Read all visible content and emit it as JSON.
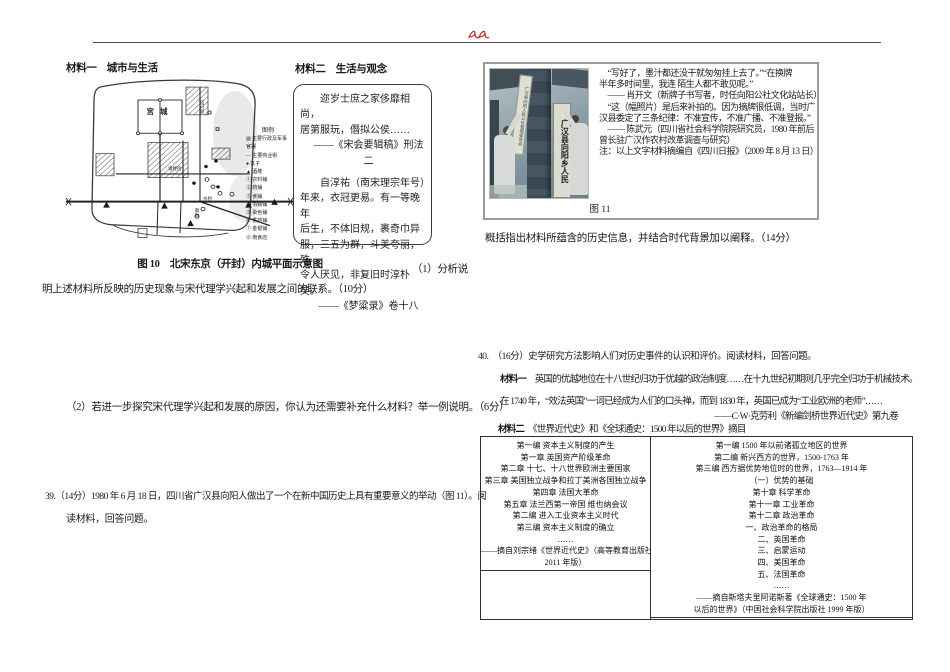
{
  "accent_color": "#cc2020",
  "left": {
    "material1_label": "材料一　城市与生活",
    "material2_label": "材料二　生活与观念",
    "map": {
      "palace_label": "宫城",
      "street_label_1": "马行街",
      "street_label_2": "潘楼街",
      "street_label_3": "州桥",
      "street_label_4": "御街",
      "legend_title": "图例",
      "legend_items": [
        "▨ 主要行政及军事官署",
        "— 主要商业街",
        "● 瓦子",
        "▲ 酒楼",
        "① 衣料铺",
        "② 药铺",
        "③ 食铺",
        "④ 书籍铺",
        "⑤ 染色铺",
        "⑥ 香药铺",
        "⑦ 金银铺",
        "⑧ 南食店"
      ],
      "caption": "图 10　北宋东京（开封）内城平面示意图"
    },
    "material2_quote_lines": [
      {
        "t": "迩岁士庶之家侈靡相尚，",
        "c": "ind"
      },
      {
        "t": "居第服玩，僭拟公侯……"
      },
      {
        "t": "——《宋会要辑稿》刑法二",
        "c": "attr"
      },
      {
        "t": "自淳祐（南宋理宗年号）",
        "c": "ind gap"
      },
      {
        "t": "年来，衣冠更易。有一等晚年"
      },
      {
        "t": "后生，不体旧规，裹奇巾异"
      },
      {
        "t": "服，三五为群，斗美夸丽，殊"
      },
      {
        "t": "令人厌见，非复旧时淳朴矣。"
      },
      {
        "t": "——《梦粱录》卷十八",
        "c": "attr"
      }
    ],
    "q1_lead": "（1）分析说",
    "q1_wrap": "明上述材料所反映的历史现象与宋代理学兴起和发展之间的联系。（10分）",
    "q2": "（2）若进一步探究宋代理学兴起和发展的原因，你认为还需要补充什么材料？举一例说明。（6分）",
    "q39_line1": "39.（14分）1980 年 6 月 18 日，四川省广汉县向阳人做出了一个在新中国历史上具有重要意义的举动（图 11）。阅",
    "q39_line2": "读材料，回答问题。"
  },
  "right": {
    "figure": {
      "caption": "图 11",
      "old_sign_text": "广汉县向阳人民公社管理委员会",
      "new_sign_text": "广汉县向阳乡人民"
    },
    "quote_lines": [
      {
        "t": "　“写好了，墨汁都还没干就匆匆挂上去了。”“在换牌"
      },
      {
        "t": "半年多时间里，我连 陌生人都不敢见呢。”"
      },
      {
        "t": "　—— 肖开文（新牌子书写者，时任向阳公社文化站站长）"
      },
      {
        "t": "　“这（幅照片）是后来补拍的。因为摘牌很低调，当时广"
      },
      {
        "t": "汉县委定了三条纪律：不准宣传，不准广播、不准登报。”"
      },
      {
        "t": "　—— 陈武元（四川省社会科学院院研究员，1980 年前后"
      },
      {
        "t": "曾长驻广汉作农村改革调查与研究）"
      },
      {
        "t": "注：以上文字材料摘编自《四川日报》（2009 年 8 月 13 日）"
      }
    ],
    "q39_task": "概括指出材料所蕴含的历史信息，并结合时代背景加以阐释。（14分）",
    "q40": "40.　（16分）史学研究方法影响人们对历史事件的认识和评价。阅读材料，回答问题。",
    "material1": {
      "label": "材料一",
      "line1": "　英国的优越地位在十八世纪归功于优越的政治制度……在十九世纪初期则几乎完全归功于机械技术。",
      "line2": "在 1740 年，“效法英国”一词已经成为人们的口头禅，而到 1830 年，英国已成为“工业欧洲的老师”……",
      "attribution": "——C·W·克劳利《新编剑桥世界近代史》第九卷"
    },
    "material2": {
      "label": "材料二",
      "title": "　《世界近代史》和《全球通史：1500 年以后的世界》摘目"
    },
    "table": {
      "left_lines": [
        {
          "t": "第一编 资本主义制度的产生"
        },
        {
          "t": "第一章 英国资产阶级革命"
        },
        {
          "t": "第二章 十七、十八世界欧洲主要国家"
        },
        {
          "t": "第三章 美国独立战争和拉丁美洲各国独立战争"
        },
        {
          "t": "第四章 法国大革命"
        },
        {
          "t": "第五章 法兰西第一帝国 维也纳会议"
        },
        {
          "t": "第二编 进入工业资本主义时代"
        },
        {
          "t": "第三编 资本主义制度的确立"
        },
        {
          "t": "……"
        },
        {
          "t": "——摘自刘宗绪《世界近代史》（高等教育出版社"
        },
        {
          "t": "2011 年版）",
          "c": "u"
        }
      ],
      "right_lines": [
        {
          "t": "第一编 1500 年以前诸孤立地区的世界"
        },
        {
          "t": "第二编 新兴西方的世界，1500-1763 年"
        },
        {
          "t": "第三编 西方据优势地位时的世界，1763—1914 年"
        },
        {
          "t": "（一）优势的基础"
        },
        {
          "t": "第十章 科学革命"
        },
        {
          "t": "第十一章 工业革命"
        },
        {
          "t": "第十二章 政治革命"
        },
        {
          "t": "一、政治革命的格局"
        },
        {
          "t": "二、英国革命"
        },
        {
          "t": "三、启蒙运动"
        },
        {
          "t": "四、美国革命"
        },
        {
          "t": "五、法国革命"
        },
        {
          "t": "……"
        },
        {
          "t": "——摘自斯塔夫里阿诺斯著《全球通史：1500 年"
        },
        {
          "t": "以后的世界》（中国社会科学院出版社 1999 年版）",
          "c": "u"
        }
      ]
    }
  }
}
